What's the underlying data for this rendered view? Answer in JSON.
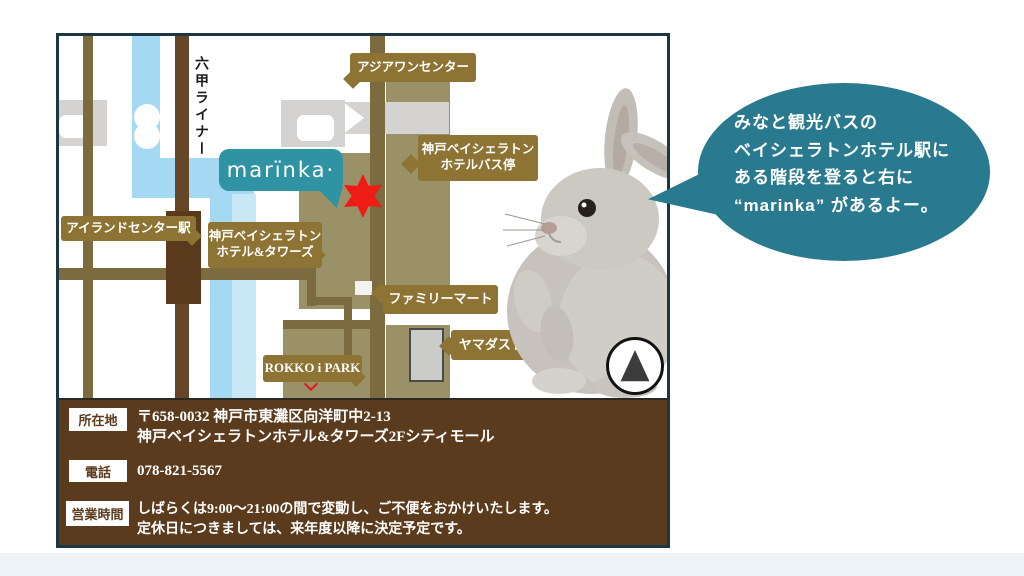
{
  "colors": {
    "card_border": "#1d3644",
    "liner_blue": "#a5d8f2",
    "road_olive": "#7b6b3f",
    "road_dark_brown": "#654727",
    "block_khaki": "#9a9168",
    "building_gray": "#d4d3d1",
    "label_gold": "#8d7434",
    "logo_teal": "#2f93a3",
    "bubble_teal": "#29798f",
    "star_red": "#ee1c16",
    "info_brown": "#5b3b1d"
  },
  "map": {
    "rokko_liner": "六甲ライナー",
    "asia_one_center": "アジアワンセンター",
    "bus_stop_line1": "神戸ベイシェラトン",
    "bus_stop_line2": "ホテルバス停",
    "island_center_station": "アイランドセンター駅",
    "hotel_line1": "神戸ベイシェラトン",
    "hotel_line2": "ホテル&タワーズ",
    "family_mart": "ファミリーマート",
    "yamada_store": "ヤマダストアー",
    "rokko_i_park": "ROKKO i PARK",
    "logo_text": "marïnka·"
  },
  "speech_bubble": {
    "line1": "みなと観光バスの",
    "line2": "ベイシェラトンホテル駅に",
    "line3": "ある階段を登ると右に",
    "line4": "“marinka” があるよー。"
  },
  "info": {
    "address_label": "所在地",
    "address_line1": "〒658-0032 神戸市東灘区向洋町中2-13",
    "address_line2": "神戸ベイシェラトンホテル&タワーズ2Fシティモール",
    "phone_label": "電話",
    "phone_value": "078-821-5567",
    "hours_label": "営業時間",
    "hours_line1": "しばらくは9:00〜21:00の間で変動し、ご不便をおかけいたします。",
    "hours_line2": "定休日につきましては、来年度以降に決定予定です。"
  }
}
